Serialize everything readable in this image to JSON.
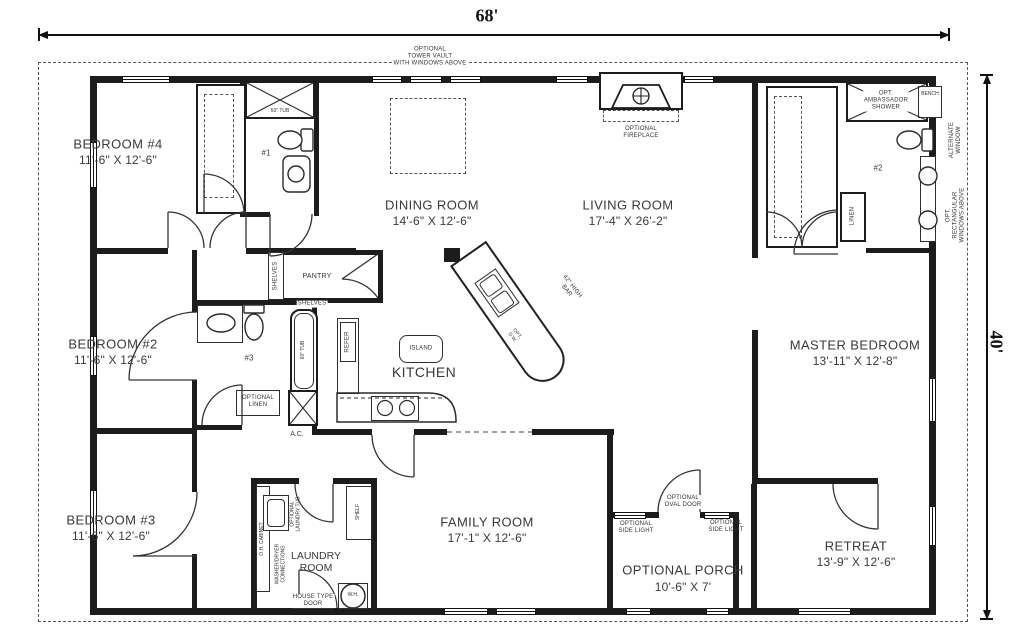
{
  "dimensions": {
    "width_label": "68'",
    "height_label": "40'"
  },
  "rooms": {
    "bedroom4": {
      "name": "BEDROOM #4",
      "size": "11'-6\" X 12'-6\""
    },
    "bedroom2": {
      "name": "BEDROOM #2",
      "size": "11'-6\" X 12'-6\""
    },
    "bedroom3": {
      "name": "BEDROOM #3",
      "size": "11'-6\" X 12'-6\""
    },
    "dining": {
      "name": "DINING ROOM",
      "size": "14'-6\" X 12'-6\""
    },
    "living": {
      "name": "LIVING ROOM",
      "size": "17'-4\" X 26'-2\""
    },
    "master": {
      "name": "MASTER BEDROOM",
      "size": "13'-11\" X 12'-8\""
    },
    "kitchen": {
      "name": "KITCHEN"
    },
    "family": {
      "name": "FAMILY ROOM",
      "size": "17'-1\" X 12'-6\""
    },
    "laundry": {
      "name": "LAUNDRY\nROOM"
    },
    "porch": {
      "name": "OPTIONAL PORCH",
      "size": "10'-6\" X 7'"
    },
    "retreat": {
      "name": "RETREAT",
      "size": "13'-9\" X 12'-6\""
    }
  },
  "annotations": {
    "tower_vault": "OPTIONAL\nTOWER VAULT\nWITH WINDOWS ABOVE",
    "fireplace": "OPTIONAL\nFIREPLACE",
    "shower": "OPT.\nAMBASSADOR\nSHOWER",
    "bench": "BENCH",
    "bath1": "#1",
    "bath2": "#2",
    "bath3": "#3",
    "tub1": "60\" TUB",
    "tub3": "60\" TUB",
    "linen": "LINEN",
    "alt_window": "ALTERNATE\nWINDOW",
    "rect_windows": "OPT. RECTANGULAR\nWINDOWS ABOVE",
    "pantry": "PANTRY",
    "shelves": "SHELVES",
    "shelves_side": "SHELVES",
    "refer": "REFER",
    "island": "ISLAND",
    "high_bar": "42\" HIGH\nBAR",
    "opt_dw": "OPT.\nD.W.",
    "opt_linen": "OPTIONAL\nLINEN",
    "ac": "A.C.",
    "oh_cabinet": "O.H. CABINET",
    "washer_dryer": "WASHER/DRYER\nCONNECTIONS",
    "laundry_tub": "OPTIONAL\nLAUNDRY TUB",
    "shelf": "SHELF",
    "house_door": "HOUSE TYPE\nDOOR",
    "wh": "W.H.",
    "oval_door": "OPTIONAL\nOVAL DOOR",
    "side_light_left": "OPTIONAL\nSIDE LIGHT",
    "side_light_right": "OPTIONAL\nSIDE LIGHT"
  },
  "colors": {
    "wall": "#1c1c1c",
    "text": "#3a3a3a"
  }
}
